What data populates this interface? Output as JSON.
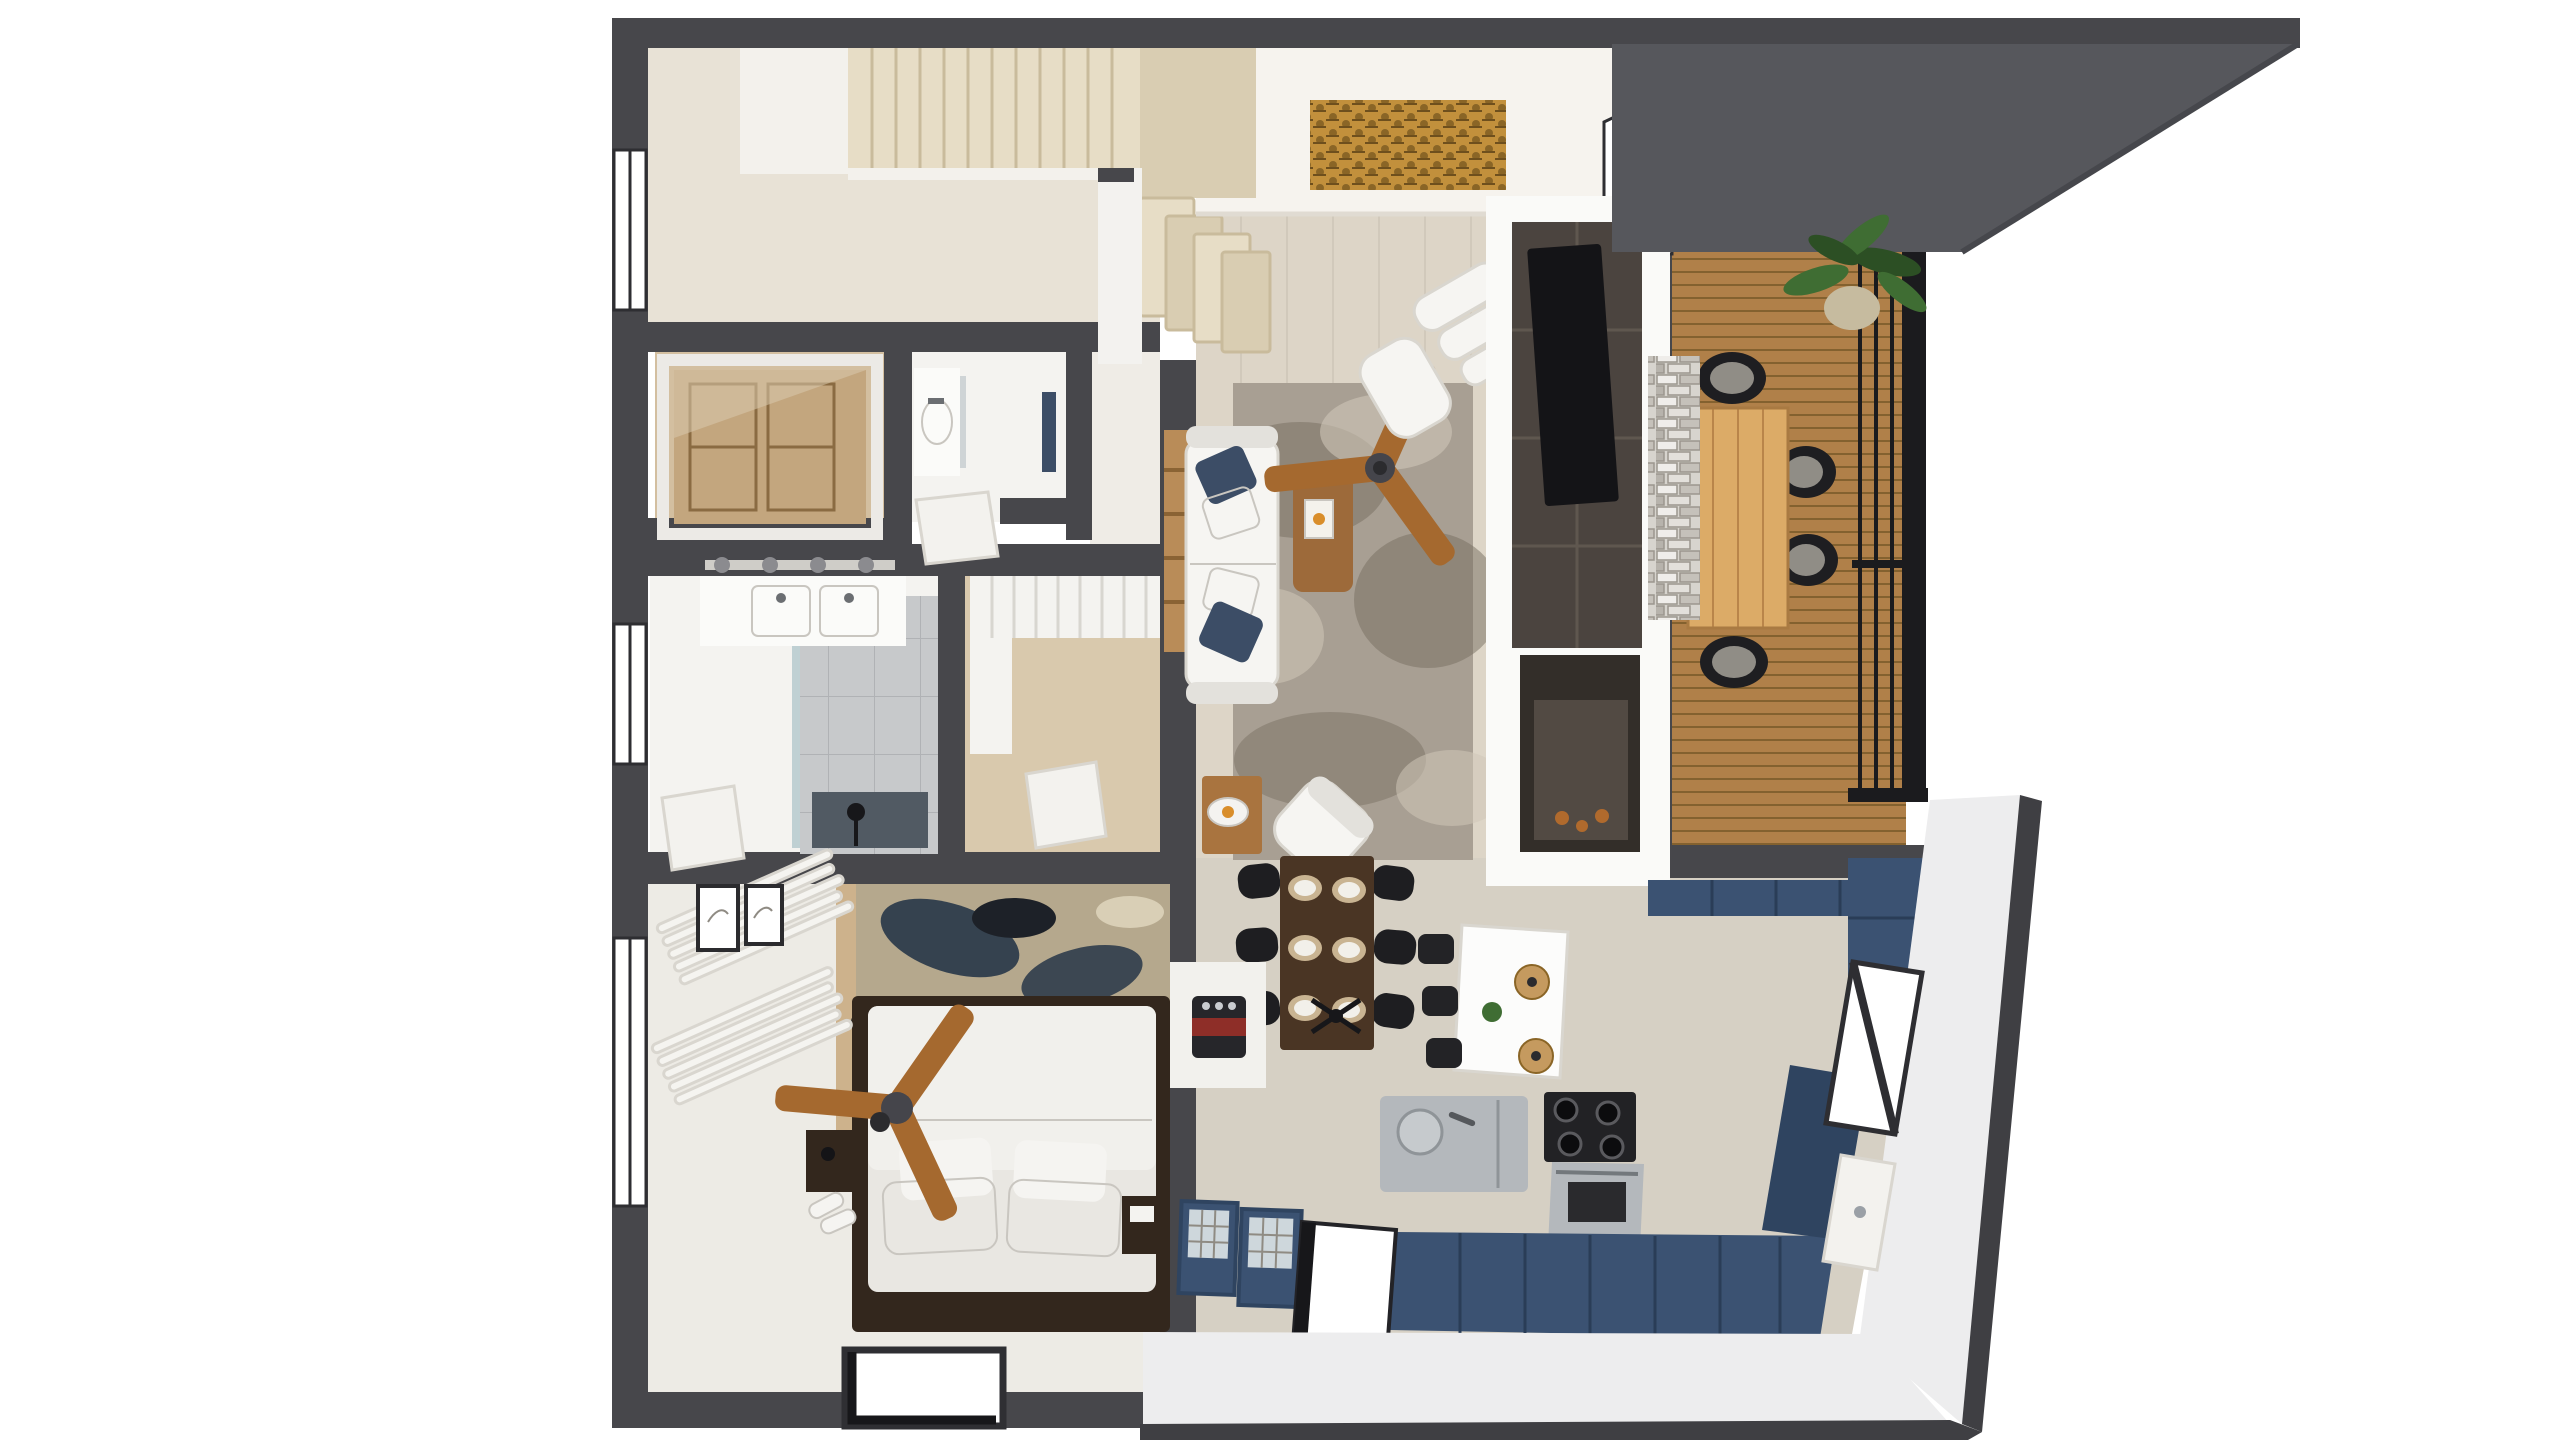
{
  "meta": {
    "kind": "3d-floor-plan-cutaway-render",
    "view": "top-down dollhouse view of a one-bedroom apartment with loft stairs",
    "background": "#ffffff"
  },
  "palette": {
    "wall": "#47474b",
    "wallDark": "#3a3a3e",
    "roof": "#56575c",
    "slabEdge": "#3f3f43",
    "bandWhite": "#ededee",
    "ceilingWhite": "#f6f3ee",
    "floorEntry": "#e8e2d6",
    "floorLiving": "#ddd5c7",
    "floorKitchen": "#d6d0c4",
    "floorBath": "#f4f3f0",
    "floorBedroom": "#edebe5",
    "floorHall": "#efece6",
    "floorClosetWood": "#d3bfa0",
    "floorWardrobe": "#d9c9ad",
    "stairTread": "#e7ddc6",
    "stairTreadDark": "#d9cdb2",
    "stairEdge": "#c9bb9c",
    "stairBox": "#f3f1ec",
    "deck": "#b08049",
    "deckLine": "#83612f",
    "railing": "#1b1b1e",
    "stone": "#d7d4ce",
    "stoneLine": "#9b968e",
    "chimney": "#fafaf8",
    "slate": "#4b443f",
    "tv": "#141417",
    "firebox": "#332e29",
    "fireGlass": "#6b625a",
    "ember": "#b06a2d",
    "rugBase": "#a89f93",
    "rugDark": "#766d60",
    "rugLight": "#cfc7b8",
    "sofa": "#f6f5f2",
    "sofaShadow": "#e3e1dc",
    "pillowNavy": "#3c4d66",
    "pillowWhite": "#f5f4f1",
    "woodShelf": "#b98c58",
    "coffeeTable": "#9d6a3a",
    "sideTable": "#a9743f",
    "candle": "#d98e2b",
    "fanWood": "#a5692f",
    "fanHub": "#45454b",
    "fanHubDark": "#2b2b2e",
    "gold": "#c2903c",
    "goldDark": "#8a6526",
    "plant": "#3f6d33",
    "plantDark": "#2c4f24",
    "pot": "#c6bb9f",
    "outdoorTable": "#dcab67",
    "outdoorTableLine": "#b9854a",
    "chairBlack": "#1e1e21",
    "cushionGray": "#908d86",
    "diningTable": "#4a3524",
    "plate": "#f2f0ea",
    "charger": "#c9b492",
    "island": "#fcfcfb",
    "stool": "#232326",
    "pendantWood": "#c59a5f",
    "cabinetBlue": "#3b5272",
    "cabinetBlueDark": "#2f4460",
    "stainless": "#b4b8bc",
    "stainlessDark": "#8f9498",
    "cooktop": "#222225",
    "windowFrame": "#2e2e32",
    "glass": "#ffffff",
    "curtain": "#f5f4f0",
    "door": "#f3f2ee",
    "tile": "#c7c9cb",
    "tileDark": "#515a63",
    "showerGlass": "#aec4c9",
    "vanity": "#fbfbf9",
    "mattress": "#e9e7e2",
    "duvet": "#f1f0ec",
    "pillowGray": "#b8b5af",
    "bedFrame": "#33271d",
    "nightstand": "#33271d",
    "woodPanel": "#cdb28c",
    "rugBedBase": "#b5a88d",
    "rugBedNavy": "#273648",
    "rugBedBlack": "#1d2128",
    "rugBedCream": "#d9cfb6",
    "ledge": "#f2f1ed",
    "espresso": "#26262a",
    "espressoRed": "#8e2e28",
    "voidWhite": "#ffffff"
  },
  "scene": {
    "rooms": [
      {
        "id": "entry-stairs",
        "items": [
          "wood staircase upper flight",
          "stair landing",
          "lower winder steps",
          "window"
        ]
      },
      {
        "id": "closet-room",
        "items": [
          "wood panel wardrobe behind white frame"
        ]
      },
      {
        "id": "powder-room",
        "items": [
          "vanity sink",
          "mirror",
          "navy accent"
        ]
      },
      {
        "id": "bathroom",
        "items": [
          "double sink vanity",
          "track light",
          "glass shower",
          "gray tile",
          "white door",
          "window"
        ]
      },
      {
        "id": "walk-in-closet",
        "items": [
          "white wardrobe",
          "wood floor",
          "white door"
        ]
      },
      {
        "id": "bedroom",
        "items": [
          "platform bed",
          "abstract rug",
          "ceiling fan",
          "two nightstands",
          "framed art x2",
          "curtained windows",
          "slippers",
          "floor opening"
        ]
      },
      {
        "id": "living-room",
        "items": [
          "white sofa with navy pillows",
          "gray shag rug",
          "wood ceiling fan",
          "wood coffee table with book",
          "white armchair",
          "lounge chair with ottoman",
          "gold wall art",
          "ladder shelf",
          "side table with candle",
          "potted plant"
        ]
      },
      {
        "id": "tv-fireplace-wall",
        "items": [
          "slate media wall",
          "flat TV",
          "double-sided fireplace",
          "stacked stone column"
        ]
      },
      {
        "id": "dining-area",
        "items": [
          "dark wood table",
          "six black chairs",
          "six place settings",
          "black pendant"
        ]
      },
      {
        "id": "kitchen",
        "items": [
          "navy blue cabinets",
          "white island with stools",
          "two wood pendants",
          "stainless counter with sink",
          "gas cooktop and range",
          "glass-front bar cabinets",
          "espresso machine",
          "pantry column",
          "window",
          "side door",
          "floor opening"
        ]
      },
      {
        "id": "balcony",
        "items": [
          "wood slat deck",
          "outdoor dining table",
          "four black wicker chairs",
          "potted plant",
          "black railing",
          "dark roof overhang"
        ]
      }
    ]
  }
}
